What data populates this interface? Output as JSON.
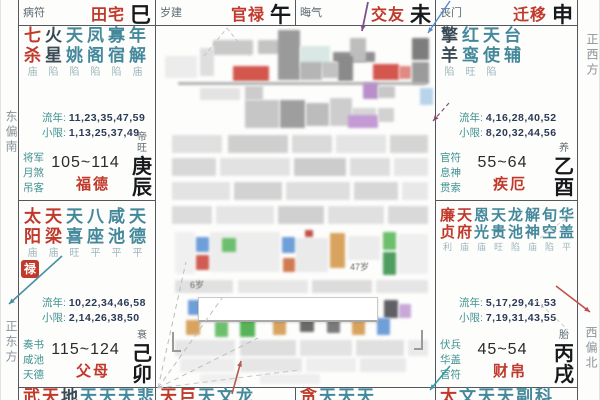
{
  "compass": {
    "east_south": "东偏南",
    "due_east": "正东方",
    "due_west": "正西方",
    "west_north": "西偏北"
  },
  "labels": {
    "liunian": "流年:",
    "xiaoxian": "小限:"
  },
  "top_row": [
    {
      "key": "tianzhai",
      "god": "病符",
      "palace": "田宅",
      "branch": "巳"
    },
    {
      "key": "guanlu",
      "god": "岁建",
      "palace": "官禄",
      "branch": "午"
    },
    {
      "key": "jiaoyou",
      "god": "晦气",
      "palace": "交友",
      "branch": "未"
    },
    {
      "key": "qianyi",
      "god": "丧门",
      "palace": "迁移",
      "branch": "申"
    }
  ],
  "palaces": [
    {
      "key": "fude",
      "row": "row2",
      "col": "left",
      "dense": false,
      "stars": [
        [
          "七杀",
          "major"
        ],
        [
          "火星",
          "malefic"
        ],
        [
          "天姚",
          "minor"
        ],
        [
          "凤阁",
          "minor"
        ],
        [
          "寡宿",
          "minor"
        ],
        [
          "年解",
          "minor"
        ]
      ],
      "statuses": [
        "庙",
        "陷",
        "陷",
        "陷",
        "陷",
        "庙"
      ],
      "liunian": "11,23,35,47,59",
      "xiaoxian": "1,13,25,37,49",
      "growth": "帝旺",
      "gods": [
        "将军",
        "月煞",
        "吊客"
      ],
      "range": "105~114",
      "name": "福德",
      "stem_branch": "庚辰",
      "badge": ""
    },
    {
      "key": "jie",
      "row": "row2",
      "col": "right",
      "dense": false,
      "stars": [
        [
          "擎羊",
          "malefic"
        ],
        [
          "红鸾",
          "minor"
        ],
        [
          "天使",
          "minor"
        ],
        [
          "台辅",
          "minor"
        ]
      ],
      "statuses": [
        "陷",
        "旺",
        "陷"
      ],
      "liunian": "4,16,28,40,52",
      "xiaoxian": "8,20,32,44,56",
      "growth": "养",
      "gods": [
        "官符",
        "息神",
        "贯索"
      ],
      "range": "55~64",
      "name": "疾厄",
      "stem_branch": "乙酉",
      "badge": ""
    },
    {
      "key": "fumu",
      "row": "row3",
      "col": "left",
      "dense": false,
      "stars": [
        [
          "太阳",
          "major"
        ],
        [
          "天梁",
          "major"
        ],
        [
          "天喜",
          "minor"
        ],
        [
          "八座",
          "minor"
        ],
        [
          "咸池",
          "minor"
        ],
        [
          "天德",
          "minor"
        ]
      ],
      "statuses": [
        "庙",
        "庙",
        "旺",
        "平",
        "平",
        "平"
      ],
      "liunian": "10,22,34,46,58",
      "xiaoxian": "2,14,26,38,50",
      "growth": "衰",
      "gods": [
        "奏书",
        "咸池",
        "天德"
      ],
      "range": "115~124",
      "name": "父母",
      "stem_branch": "己卯",
      "badge": "禄"
    },
    {
      "key": "caibo",
      "row": "row3",
      "col": "right",
      "dense": true,
      "stars": [
        [
          "廉贞",
          "major"
        ],
        [
          "天府",
          "major"
        ],
        [
          "恩光",
          "minor"
        ],
        [
          "天贵",
          "minor"
        ],
        [
          "龙池",
          "minor"
        ],
        [
          "解神",
          "minor"
        ],
        [
          "旬空",
          "minor"
        ],
        [
          "华盖",
          "minor"
        ]
      ],
      "statuses": [
        "利",
        "庙",
        "庙",
        "旺",
        "陷",
        "庙",
        "陷",
        "平"
      ],
      "liunian": "5,17,29,41,53",
      "xiaoxian": "7,19,31,43,55",
      "growth": "胎",
      "gods": [
        "伏兵",
        "华盖",
        "官符"
      ],
      "range": "45~54",
      "name": "财帛",
      "stem_branch": "丙戌",
      "badge": ""
    }
  ],
  "bottom_row": [
    {
      "chars": [
        [
          "武",
          "major"
        ],
        [
          "天",
          "major"
        ],
        [
          "地",
          "malefic"
        ],
        [
          "天",
          "minor"
        ],
        [
          "天",
          "minor"
        ],
        [
          "天",
          "minor"
        ],
        [
          "悲",
          "minor"
        ]
      ]
    },
    {
      "chars": [
        [
          "天",
          "major"
        ],
        [
          "巨",
          "major"
        ],
        [
          "天",
          "minor"
        ],
        [
          "文",
          "minor"
        ],
        [
          "龙",
          "minor"
        ]
      ]
    },
    {
      "chars": [
        [
          "贪",
          "major"
        ],
        [
          "天",
          "minor"
        ],
        [
          "天",
          "minor"
        ],
        [
          "天",
          "minor"
        ]
      ]
    },
    {
      "chars": [
        [
          "太",
          "major"
        ],
        [
          "文",
          "minor"
        ],
        [
          "天",
          "minor"
        ],
        [
          "天",
          "minor"
        ],
        [
          "副",
          "minor"
        ],
        [
          "科",
          "minor"
        ]
      ]
    }
  ],
  "center_blur": {
    "texts": [
      {
        "x": 190,
        "y": 278,
        "t": "6岁"
      },
      {
        "x": 350,
        "y": 260,
        "t": "47岁"
      }
    ],
    "tooltip": {
      "x": 198,
      "y": 297,
      "w": 178,
      "h": 22
    },
    "blocks": [
      [
        213,
        40,
        40,
        15,
        "#c9c9c9"
      ],
      [
        258,
        40,
        24,
        14,
        "#c4c4c4"
      ],
      [
        278,
        30,
        22,
        50,
        "#9a9a9a"
      ],
      [
        300,
        46,
        30,
        22,
        "#d9e8e4"
      ],
      [
        333,
        52,
        42,
        10,
        "#8f8f8f"
      ],
      [
        350,
        38,
        16,
        24,
        "#bdbdbd"
      ],
      [
        200,
        48,
        14,
        28,
        "#dedede"
      ],
      [
        165,
        56,
        32,
        22,
        "#ececec"
      ],
      [
        233,
        66,
        36,
        15,
        "#d4574e"
      ],
      [
        300,
        62,
        22,
        18,
        "#b5b5b5"
      ],
      [
        322,
        62,
        16,
        16,
        "#c2c2c2"
      ],
      [
        338,
        56,
        15,
        25,
        "#8a8a8a"
      ],
      [
        373,
        64,
        26,
        16,
        "#d4574e"
      ],
      [
        399,
        66,
        12,
        13,
        "#e08a84"
      ],
      [
        412,
        38,
        17,
        22,
        "#7d7d7d"
      ],
      [
        412,
        62,
        17,
        22,
        "#9b9b9b"
      ],
      [
        178,
        82,
        248,
        3,
        "#b0b0b0"
      ],
      [
        200,
        88,
        40,
        12,
        "#e3e3e3"
      ],
      [
        245,
        86,
        18,
        14,
        "#cccccc"
      ],
      [
        363,
        83,
        15,
        16,
        "#b88fc9"
      ],
      [
        378,
        86,
        17,
        12,
        "#c7c7c7"
      ],
      [
        420,
        88,
        13,
        17,
        "#b8d4ea"
      ],
      [
        245,
        100,
        34,
        28,
        "#c6c6c6"
      ],
      [
        280,
        100,
        25,
        28,
        "#9e9e9e"
      ],
      [
        306,
        103,
        23,
        23,
        "#bcbcbc"
      ],
      [
        330,
        98,
        22,
        28,
        "#cdcdcd"
      ],
      [
        352,
        108,
        24,
        14,
        "#d6d6d6"
      ],
      [
        348,
        115,
        30,
        13,
        "#c49ad4"
      ],
      [
        378,
        108,
        16,
        14,
        "#d2d2d2"
      ],
      [
        172,
        135,
        50,
        18,
        "#e0e0e0"
      ],
      [
        228,
        135,
        60,
        18,
        "#cfcfcf"
      ],
      [
        292,
        135,
        40,
        18,
        "#dadada"
      ],
      [
        336,
        135,
        50,
        18,
        "#e4e4e4"
      ],
      [
        390,
        135,
        38,
        18,
        "#d5d5d5"
      ],
      [
        172,
        158,
        44,
        18,
        "#d8d8d8"
      ],
      [
        220,
        158,
        70,
        18,
        "#e2e2e2"
      ],
      [
        294,
        158,
        52,
        18,
        "#cccccc"
      ],
      [
        350,
        158,
        40,
        18,
        "#dddddd"
      ],
      [
        394,
        158,
        34,
        18,
        "#e6e6e6"
      ],
      [
        172,
        182,
        58,
        18,
        "#e3e3e3"
      ],
      [
        234,
        182,
        48,
        18,
        "#d2d2d2"
      ],
      [
        286,
        182,
        64,
        18,
        "#dedede"
      ],
      [
        354,
        182,
        44,
        18,
        "#d7d7d7"
      ],
      [
        402,
        182,
        26,
        18,
        "#e8e8e8"
      ],
      [
        172,
        206,
        40,
        18,
        "#dcdcdc"
      ],
      [
        216,
        206,
        58,
        18,
        "#e5e5e5"
      ],
      [
        278,
        206,
        46,
        18,
        "#d0d0d0"
      ],
      [
        328,
        206,
        56,
        18,
        "#e0e0e0"
      ],
      [
        388,
        206,
        40,
        18,
        "#d9d9d9"
      ],
      [
        175,
        232,
        20,
        42,
        "#f0f0f0"
      ],
      [
        210,
        232,
        70,
        40,
        "#ededed"
      ],
      [
        296,
        238,
        32,
        34,
        "#eaeaea"
      ],
      [
        348,
        236,
        32,
        24,
        "#ececec"
      ],
      [
        398,
        234,
        30,
        40,
        "#efefef"
      ],
      [
        196,
        237,
        13,
        15,
        "#6f9fd8"
      ],
      [
        196,
        255,
        13,
        15,
        "#d05c52"
      ],
      [
        222,
        238,
        14,
        14,
        "#6cbf6c"
      ],
      [
        282,
        237,
        13,
        16,
        "#6f9fd8"
      ],
      [
        283,
        258,
        12,
        14,
        "#d07a52"
      ],
      [
        330,
        233,
        15,
        35,
        "#d8a35f"
      ],
      [
        305,
        230,
        8,
        7,
        "#c05048"
      ],
      [
        383,
        232,
        13,
        18,
        "#6cbf6c"
      ],
      [
        383,
        252,
        13,
        23,
        "#4e9e5f"
      ],
      [
        175,
        280,
        58,
        13,
        "#e1e1e1"
      ],
      [
        238,
        280,
        70,
        13,
        "#e7e7e7"
      ],
      [
        312,
        280,
        60,
        13,
        "#dcdcdc"
      ],
      [
        376,
        280,
        52,
        13,
        "#e5e5e5"
      ],
      [
        188,
        300,
        13,
        15,
        "#6f9fd8"
      ],
      [
        225,
        304,
        13,
        14,
        "#c9a8d8"
      ],
      [
        243,
        300,
        14,
        18,
        "#d8a35f"
      ],
      [
        384,
        300,
        14,
        18,
        "#5f6064"
      ],
      [
        399,
        304,
        12,
        14,
        "#c9a8d8"
      ],
      [
        186,
        320,
        14,
        15,
        "#d8a35f"
      ],
      [
        215,
        322,
        13,
        15,
        "#6cbf6c"
      ],
      [
        240,
        318,
        15,
        19,
        "#57b357"
      ],
      [
        273,
        320,
        13,
        15,
        "#d8a35f"
      ],
      [
        300,
        320,
        14,
        12,
        "#6a6a6a"
      ],
      [
        327,
        320,
        13,
        13,
        "#7a7a7a"
      ],
      [
        352,
        320,
        13,
        15,
        "#d8a35f"
      ],
      [
        377,
        318,
        13,
        17,
        "#6f9fd8"
      ],
      [
        175,
        340,
        60,
        16,
        "#e6e6e6"
      ],
      [
        240,
        340,
        56,
        16,
        "#dedede"
      ],
      [
        300,
        340,
        52,
        16,
        "#e3e3e3"
      ],
      [
        356,
        340,
        48,
        16,
        "#e0e0e0"
      ],
      [
        408,
        340,
        20,
        16,
        "#eaeaea"
      ],
      [
        180,
        358,
        55,
        14,
        "#ededed"
      ],
      [
        240,
        358,
        62,
        14,
        "#e6e6e6"
      ],
      [
        306,
        358,
        50,
        14,
        "#eeeeee"
      ],
      [
        360,
        358,
        46,
        14,
        "#e9e9e9"
      ],
      [
        200,
        374,
        40,
        10,
        "#f0f0f0"
      ],
      [
        260,
        374,
        60,
        10,
        "#eeeeee"
      ]
    ]
  },
  "arrows": [
    {
      "x1": 62,
      "y1": 256,
      "x2": 9,
      "y2": 304,
      "c": "#4a90a4",
      "w": 1.6,
      "head": true,
      "dash": ""
    },
    {
      "x1": 368,
      "y1": 2,
      "x2": 362,
      "y2": 31,
      "c": "#7d4f8d",
      "w": 1.8,
      "head": true,
      "dash": ""
    },
    {
      "x1": 450,
      "y1": 1,
      "x2": 428,
      "y2": 33,
      "c": "#5b8bc9",
      "w": 1.4,
      "head": true,
      "dash": ""
    },
    {
      "x1": 556,
      "y1": 286,
      "x2": 590,
      "y2": 312,
      "c": "#c0504d",
      "w": 1.6,
      "head": true,
      "dash": ""
    },
    {
      "x1": 450,
      "y1": 366,
      "x2": 430,
      "y2": 390,
      "c": "#3a9aa8",
      "w": 1.6,
      "head": true,
      "dash": ""
    },
    {
      "x1": 232,
      "y1": 394,
      "x2": 241,
      "y2": 361,
      "c": "#b05a52",
      "w": 1.6,
      "head": true,
      "dash": ""
    },
    {
      "x1": 449,
      "y1": 103,
      "x2": 433,
      "y2": 121,
      "c": "#8d4a6a",
      "w": 1.2,
      "head": true,
      "dash": "4 3"
    },
    {
      "x1": 158,
      "y1": 388,
      "x2": 186,
      "y2": 262,
      "c": "#bdbdbd",
      "w": 1,
      "head": false,
      "dash": "5 4"
    },
    {
      "x1": 158,
      "y1": 388,
      "x2": 222,
      "y2": 298,
      "c": "#bdbdbd",
      "w": 1,
      "head": false,
      "dash": "5 4"
    },
    {
      "x1": 158,
      "y1": 388,
      "x2": 258,
      "y2": 338,
      "c": "#bdbdbd",
      "w": 1,
      "head": false,
      "dash": "5 4"
    },
    {
      "x1": 158,
      "y1": 388,
      "x2": 300,
      "y2": 370,
      "c": "#c6c6c6",
      "w": 1,
      "head": false,
      "dash": "5 4"
    },
    {
      "x1": 204,
      "y1": 56,
      "x2": 227,
      "y2": 28,
      "c": "#c6c6c6",
      "w": 1,
      "head": false,
      "dash": "4 3"
    },
    {
      "x1": 227,
      "y1": 28,
      "x2": 249,
      "y2": 56,
      "c": "#c6c6c6",
      "w": 1,
      "head": false,
      "dash": "4 3"
    },
    {
      "x1": 540,
      "y1": 238,
      "x2": 572,
      "y2": 214,
      "c": "#cccccc",
      "w": 1,
      "head": false,
      "dash": "4 3"
    },
    {
      "x1": 536,
      "y1": 300,
      "x2": 568,
      "y2": 330,
      "c": "#cccccc",
      "w": 1,
      "head": false,
      "dash": "4 3"
    }
  ],
  "geometry": {
    "top_cells": [
      [
        18,
        0,
        137,
        25
      ],
      [
        155,
        0,
        140,
        25
      ],
      [
        295,
        0,
        140,
        25
      ],
      [
        435,
        0,
        142,
        25
      ]
    ],
    "palace_cells": [
      [
        18,
        25,
        137,
        175
      ],
      [
        435,
        25,
        142,
        175
      ],
      [
        18,
        200,
        137,
        187
      ],
      [
        435,
        200,
        142,
        187
      ]
    ],
    "sliver_cells": [
      [
        18,
        387,
        137,
        13
      ],
      [
        155,
        387,
        140,
        13
      ],
      [
        295,
        387,
        140,
        13
      ],
      [
        435,
        387,
        142,
        13
      ]
    ],
    "vlines_full": [
      18,
      155,
      435,
      577
    ],
    "vlines_partial": [
      295
    ],
    "hline_top": 25,
    "hline_mid": 200,
    "hline_bottom": 387
  }
}
